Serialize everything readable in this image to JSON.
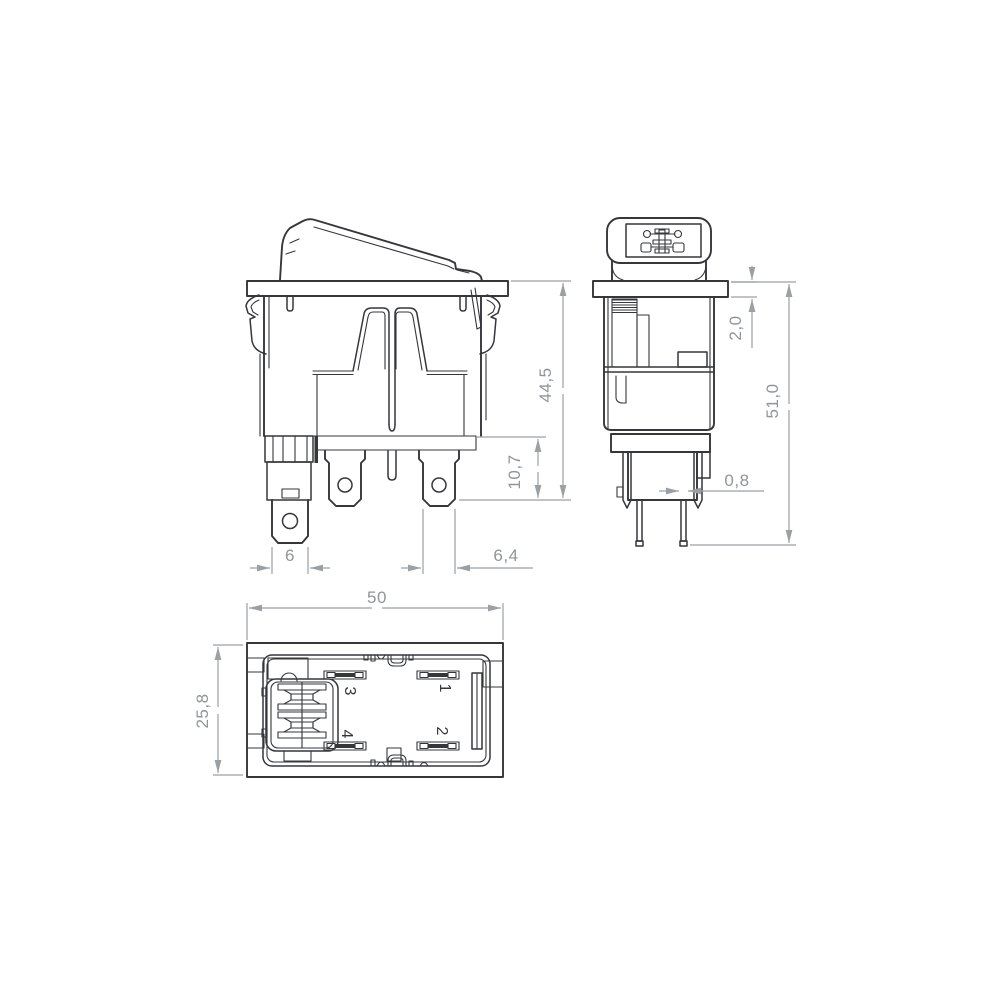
{
  "dimensions": {
    "front": {
      "height": "44,5",
      "terminal_length": "10,7",
      "left_terminal_width": "6",
      "terminal_width": "6,4"
    },
    "side": {
      "flange_thickness": "2,0",
      "total_height": "51,0",
      "terminal_thickness": "0,8"
    },
    "bottom": {
      "width": "50",
      "depth": "25,8"
    }
  },
  "terminal_labels": {
    "t1": "1",
    "t2": "2",
    "t3": "3",
    "t4": "4"
  },
  "colors": {
    "line": "#35373a",
    "dimension": "#9aa0a3",
    "dimension_text": "#8f9599",
    "background": "#ffffff"
  }
}
